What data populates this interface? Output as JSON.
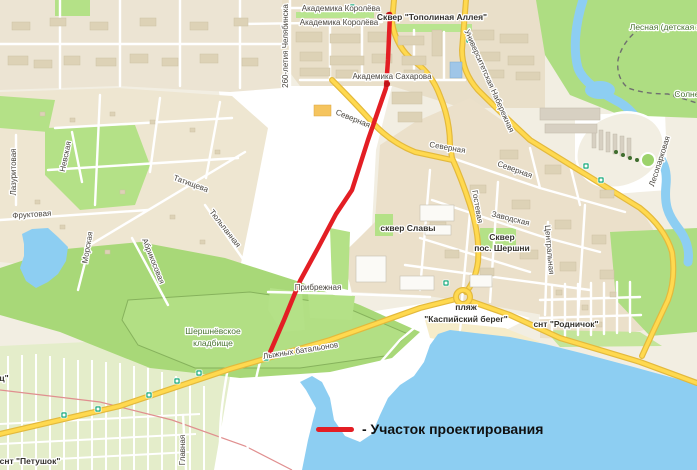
{
  "map": {
    "colors": {
      "water": "#8dcef2",
      "land": "#f2eee2",
      "forest_green": "#aedd82",
      "cemetery_green": "#b2df84",
      "urban_block": "#e9dfc9",
      "road_yellow": "#ffd94f",
      "project_line_red": "#e31e24"
    },
    "legend": {
      "swatch_color": "#e31e24",
      "label": "- Участок проектирования"
    },
    "project_line": {
      "points": "390,14 388,60 386,88 368,140 352,190 336,214 318,248 300,281 284,320 268,357",
      "endpoints": [
        [
          389,
          15
        ],
        [
          387,
          84
        ]
      ]
    },
    "bus_stops": [
      [
        64,
        415
      ],
      [
        98,
        409
      ],
      [
        149,
        395
      ],
      [
        177,
        381
      ],
      [
        199,
        373
      ],
      [
        266,
        358
      ],
      [
        446,
        283
      ],
      [
        586,
        166
      ],
      [
        601,
        180
      ],
      [
        352,
        7
      ],
      [
        469,
        40
      ]
    ],
    "railway_stations": [
      [
        640,
        28
      ],
      [
        676,
        95
      ]
    ],
    "labels": [
      {
        "t": "Академика Королёва",
        "x": 341,
        "y": 11,
        "r": 0,
        "c": "street"
      },
      {
        "t": "Академика Королёва",
        "x": 339,
        "y": 25,
        "r": 0,
        "c": "street"
      },
      {
        "t": "Сквер \"Тополиная Аллея\"",
        "x": 432,
        "y": 20,
        "r": 0,
        "c": "place"
      },
      {
        "t": "260-летия Челябинска",
        "x": 288,
        "y": 46,
        "r": -90,
        "c": "street"
      },
      {
        "t": "Академика Сахарова",
        "x": 392,
        "y": 79,
        "r": 0,
        "c": "street"
      },
      {
        "t": "Университетская Набережная",
        "x": 487,
        "y": 82,
        "r": 66,
        "c": "street"
      },
      {
        "t": "Северная",
        "x": 352,
        "y": 121,
        "r": 22,
        "c": "street"
      },
      {
        "t": "Северная",
        "x": 447,
        "y": 150,
        "r": 10,
        "c": "street"
      },
      {
        "t": "Северная",
        "x": 514,
        "y": 172,
        "r": 20,
        "c": "street"
      },
      {
        "t": "Гостевая",
        "x": 475,
        "y": 207,
        "r": 80,
        "c": "street"
      },
      {
        "t": "Заводская",
        "x": 510,
        "y": 221,
        "r": 14,
        "c": "street"
      },
      {
        "t": "Центральная",
        "x": 547,
        "y": 250,
        "r": 85,
        "c": "street"
      },
      {
        "t": "сквер Славы",
        "x": 408,
        "y": 231,
        "r": 0,
        "c": "place"
      },
      {
        "t": "Сквер",
        "x": 502,
        "y": 240,
        "r": 0,
        "c": "place"
      },
      {
        "t": "пос. Шершни",
        "x": 502,
        "y": 251,
        "r": 0,
        "c": "place"
      },
      {
        "t": "Прибрежная",
        "x": 318,
        "y": 290,
        "r": 0,
        "c": "street"
      },
      {
        "t": "пляж",
        "x": 466,
        "y": 310,
        "r": 0,
        "c": "place"
      },
      {
        "t": "\"Каспийский берег\"",
        "x": 466,
        "y": 322,
        "r": 0,
        "c": "place"
      },
      {
        "t": "снт \"Родничок\"",
        "x": 566,
        "y": 327,
        "r": 0,
        "c": "place"
      },
      {
        "t": "Шершнёвское",
        "x": 213,
        "y": 334,
        "r": 0,
        "c": "nature"
      },
      {
        "t": "кладбище",
        "x": 213,
        "y": 346,
        "r": 0,
        "c": "nature"
      },
      {
        "t": "Лыжных батальонов",
        "x": 301,
        "y": 353,
        "r": -9,
        "c": "street"
      },
      {
        "t": "Татищева",
        "x": 190,
        "y": 186,
        "r": 20,
        "c": "street"
      },
      {
        "t": "Тюльпанная",
        "x": 223,
        "y": 230,
        "r": 52,
        "c": "street"
      },
      {
        "t": "Абрикосовая",
        "x": 151,
        "y": 262,
        "r": 68,
        "c": "street"
      },
      {
        "t": "Морская",
        "x": 90,
        "y": 248,
        "r": -80,
        "c": "street"
      },
      {
        "t": "Невская",
        "x": 68,
        "y": 157,
        "r": -78,
        "c": "street"
      },
      {
        "t": "Лазуритовая",
        "x": 16,
        "y": 172,
        "r": -90,
        "c": "street"
      },
      {
        "t": "Фруктовая",
        "x": 32,
        "y": 217,
        "r": -4,
        "c": "street"
      },
      {
        "t": "Главная",
        "x": 185,
        "y": 450,
        "r": -90,
        "c": "street"
      },
      {
        "t": "снт \"Петушок\"",
        "x": 30,
        "y": 464,
        "r": 0,
        "c": "place"
      },
      {
        "t": "ц\"",
        "x": 4,
        "y": 381,
        "r": 0,
        "c": "place"
      },
      {
        "t": "Лесная (детская ж",
        "x": 666,
        "y": 30,
        "r": 0,
        "c": "nature"
      },
      {
        "t": "Солнеч",
        "x": 689,
        "y": 97,
        "r": 0,
        "c": "nature"
      },
      {
        "t": "Лесопарковая",
        "x": 662,
        "y": 162,
        "r": -72,
        "c": "street"
      }
    ]
  }
}
